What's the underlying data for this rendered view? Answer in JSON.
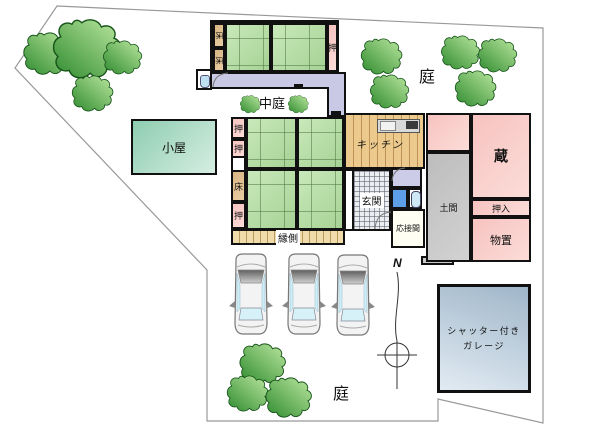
{
  "site": {
    "garden_top": "庭",
    "garden_bottom": "庭",
    "courtyard": "中庭",
    "north": "N"
  },
  "shed": {
    "label": "小屋"
  },
  "annex": {
    "toko_cells": [
      "床",
      "床"
    ],
    "closet": "押"
  },
  "main": {
    "side_cells": [
      "押",
      "押",
      "床",
      "押"
    ],
    "kitchen": "キッチン",
    "genkan": "玄関",
    "reception": "応接間",
    "engawa": "縁側"
  },
  "east": {
    "kura": "蔵",
    "oshiire": "押入",
    "monooki": "物置",
    "doma": "土間"
  },
  "garage": {
    "line1": "シャッター付き",
    "line2": "ガレージ"
  },
  "colors": {
    "tatami_green": "#b8dcaa",
    "closet_pink": "#f8cdc9",
    "tokonoma_tan": "#d9b583",
    "hallway_lavender": "#c9c9e6",
    "doma_gray": "#c6c6c6",
    "kitchen_wood": "#ecca8e",
    "shed_teal": "#9fd4b8",
    "garage_bluegray": "#b7c9da",
    "tree_green": "#3f9e3f",
    "boundary_gray": "#999999"
  }
}
